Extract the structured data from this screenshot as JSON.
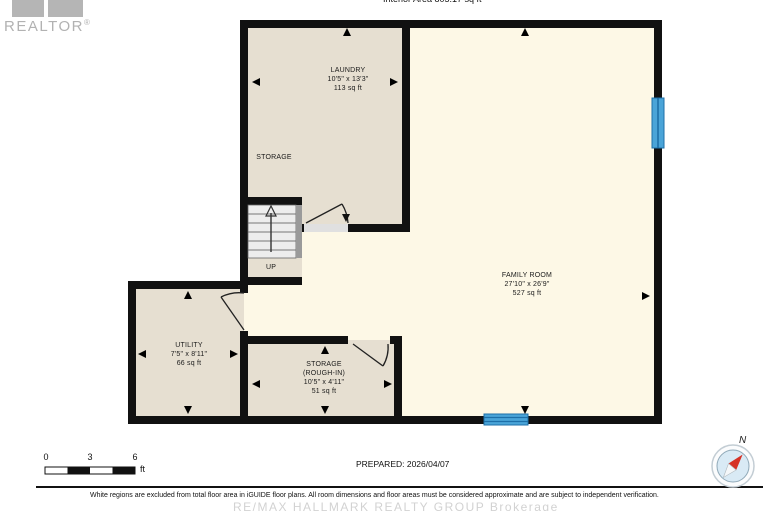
{
  "header": {
    "interior_area": "Interior Area 805.17 sq ft",
    "realtor": "REALTOR",
    "registered": "®"
  },
  "rooms": {
    "laundry": {
      "name": "LAUNDRY",
      "dims": "10'5\" x 13'3\"",
      "area": "113 sq ft"
    },
    "storage_open": {
      "name": "STORAGE"
    },
    "family_room": {
      "name": "FAMILY ROOM",
      "dims": "27'10\" x 26'9\"",
      "area": "527 sq ft"
    },
    "utility": {
      "name": "UTILITY",
      "dims": "7'5\" x 8'11\"",
      "area": "66 sq ft"
    },
    "storage_rough_in": {
      "name": "STORAGE",
      "qualifier": "(ROUGH-IN)",
      "dims": "10'5\" x 4'11\"",
      "area": "51 sq ft"
    },
    "stairs": {
      "direction_label": "UP"
    }
  },
  "scale_bar": {
    "ticks": [
      "0",
      "3",
      "6"
    ],
    "unit": "ft"
  },
  "compass": {
    "north": "N"
  },
  "footer": {
    "prepared": "PREPARED: 2026/04/07",
    "disclaimer": "White regions are excluded from total floor area in iGUIDE floor plans. All room dimensions and floor areas must be considered approximate and are subject to independent verification.",
    "watermark": "RE/MAX HALLMARK REALTY GROUP Brokerage"
  },
  "colors": {
    "wall": "#111111",
    "room_beige": "#e6dfd1",
    "room_cream": "#fdf8e6",
    "window_blue": "#4aa4d8",
    "window_line": "#1d6fa8",
    "stairs_gray": "#ededed",
    "logo_gray": "#b5b5b5",
    "compass_red": "#d63226",
    "watermark_gray": "#d2d2d2"
  }
}
